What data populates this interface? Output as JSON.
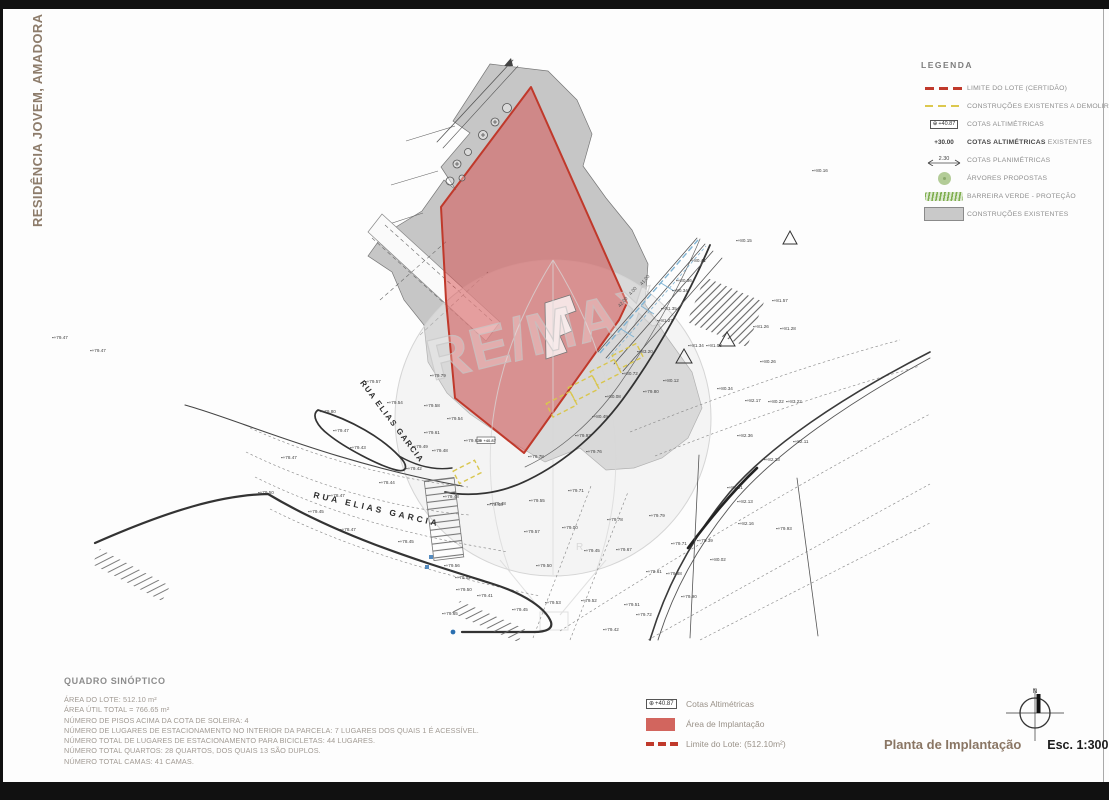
{
  "page": {
    "side_title": "RESIDÊNCIA JOVEM,  AMADORA",
    "drawing_title": "Planta de Implantação",
    "scale_label": "Esc. 1:300",
    "north_label": "N"
  },
  "colors": {
    "lot_red": "#c0392b",
    "implant_fill": "#d84a4a",
    "demolish_yellow": "#dcc84e",
    "existing_gray": "#c6c6c6",
    "tree_green": "#b3cc97",
    "barrier_green": "#7fae4f",
    "water_blue": "#7fb3d3"
  },
  "legend": {
    "title": "LEGENDA",
    "items": [
      {
        "label": "LIMITE DO LOTE (CERTIDÃO)"
      },
      {
        "label": "CONSTRUÇÕES EXISTENTES A DEMOLIR"
      },
      {
        "label": "COTAS ALTIMÉTRICAS",
        "symbol_value": "+40.87"
      },
      {
        "label_bold": "COTAS ALTIMÉTRICAS",
        "label_rest": " EXISTENTES",
        "symbol_value": "+30.00"
      },
      {
        "label": "COTAS PLANIMÉTRICAS",
        "symbol_value": "2.30"
      },
      {
        "label": "ÁRVORES PROPOSTAS"
      },
      {
        "label": "BARREIRA VERDE - PROTEÇÃO"
      },
      {
        "label": "CONSTRUÇÕES EXISTENTES"
      }
    ]
  },
  "map": {
    "watermark": "RE/MAX",
    "watermark_r": "R",
    "cota_box": "⊕ +40.87",
    "street_labels": [
      {
        "text": "RUA ELIAS GARCIA",
        "x": 390,
        "y": 423,
        "rot": 53,
        "fs": 8,
        "ls": 1.5
      },
      {
        "text": "RUA ELIAS GARCIA",
        "x": 376,
        "y": 512,
        "rot": 13,
        "fs": 8.5,
        "ls": 3
      }
    ],
    "dimension_labels": [
      {
        "text": "42.00",
        "x": 624,
        "y": 303,
        "rot": -49
      },
      {
        "text": "4.00",
        "x": 634,
        "y": 292,
        "rot": -49
      },
      {
        "text": "41.00",
        "x": 646,
        "y": 281,
        "rot": -49
      }
    ],
    "spot_elevations": [
      {
        "x": 365,
        "y": 383,
        "v": "+79.57"
      },
      {
        "x": 387,
        "y": 404,
        "v": "+79.54"
      },
      {
        "x": 424,
        "y": 407,
        "v": "+79.58"
      },
      {
        "x": 320,
        "y": 413,
        "v": "+79.80"
      },
      {
        "x": 447,
        "y": 420,
        "v": "+79.54"
      },
      {
        "x": 333,
        "y": 432,
        "v": "+79.47"
      },
      {
        "x": 424,
        "y": 434,
        "v": "+79.61"
      },
      {
        "x": 350,
        "y": 449,
        "v": "+79.43"
      },
      {
        "x": 412,
        "y": 448,
        "v": "+79.49"
      },
      {
        "x": 432,
        "y": 452,
        "v": "+79.48"
      },
      {
        "x": 281,
        "y": 459,
        "v": "+78.47"
      },
      {
        "x": 406,
        "y": 470,
        "v": "+79.42"
      },
      {
        "x": 379,
        "y": 484,
        "v": "+78.44"
      },
      {
        "x": 258,
        "y": 494,
        "v": "+79.50"
      },
      {
        "x": 329,
        "y": 497,
        "v": "+78.47"
      },
      {
        "x": 308,
        "y": 513,
        "v": "+79.45"
      },
      {
        "x": 443,
        "y": 498,
        "v": "+79.48"
      },
      {
        "x": 487,
        "y": 506,
        "v": "+79.48"
      },
      {
        "x": 340,
        "y": 531,
        "v": "+78.47"
      },
      {
        "x": 398,
        "y": 543,
        "v": "+78.45"
      },
      {
        "x": 464,
        "y": 442,
        "v": "+79.62"
      },
      {
        "x": 430,
        "y": 377,
        "v": "+79.79"
      },
      {
        "x": 528,
        "y": 458,
        "v": "+79.78"
      },
      {
        "x": 568,
        "y": 492,
        "v": "+79.71"
      },
      {
        "x": 529,
        "y": 502,
        "v": "+79.55"
      },
      {
        "x": 490,
        "y": 505,
        "v": "+79.48"
      },
      {
        "x": 607,
        "y": 521,
        "v": "+79.78"
      },
      {
        "x": 649,
        "y": 517,
        "v": "+79.79"
      },
      {
        "x": 524,
        "y": 533,
        "v": "+79.57"
      },
      {
        "x": 562,
        "y": 529,
        "v": "+79.00"
      },
      {
        "x": 584,
        "y": 552,
        "v": "+79.45"
      },
      {
        "x": 616,
        "y": 551,
        "v": "+79.67"
      },
      {
        "x": 671,
        "y": 545,
        "v": "+79.71"
      },
      {
        "x": 697,
        "y": 542,
        "v": "+79.39"
      },
      {
        "x": 710,
        "y": 561,
        "v": "+80.02"
      },
      {
        "x": 536,
        "y": 567,
        "v": "+79.50"
      },
      {
        "x": 455,
        "y": 579,
        "v": "+79.52"
      },
      {
        "x": 444,
        "y": 567,
        "v": "+79.56"
      },
      {
        "x": 456,
        "y": 591,
        "v": "+79.50"
      },
      {
        "x": 477,
        "y": 597,
        "v": "+79.41"
      },
      {
        "x": 442,
        "y": 615,
        "v": "+79.65"
      },
      {
        "x": 512,
        "y": 611,
        "v": "+79.45"
      },
      {
        "x": 545,
        "y": 604,
        "v": "+79.53"
      },
      {
        "x": 581,
        "y": 602,
        "v": "+79.52"
      },
      {
        "x": 624,
        "y": 606,
        "v": "+79.51"
      },
      {
        "x": 636,
        "y": 616,
        "v": "+79.72"
      },
      {
        "x": 666,
        "y": 575,
        "v": "+79.88"
      },
      {
        "x": 681,
        "y": 598,
        "v": "+79.90"
      },
      {
        "x": 646,
        "y": 573,
        "v": "+79.61"
      },
      {
        "x": 603,
        "y": 631,
        "v": "+79.42"
      },
      {
        "x": 690,
        "y": 262,
        "v": "+80.41"
      },
      {
        "x": 676,
        "y": 282,
        "v": "+80.36"
      },
      {
        "x": 672,
        "y": 292,
        "v": "+80.34"
      },
      {
        "x": 661,
        "y": 310,
        "v": "+81.35"
      },
      {
        "x": 657,
        "y": 322,
        "v": "+81.27"
      },
      {
        "x": 637,
        "y": 353,
        "v": "+83.20"
      },
      {
        "x": 622,
        "y": 375,
        "v": "+80.72"
      },
      {
        "x": 605,
        "y": 398,
        "v": "+80.08"
      },
      {
        "x": 592,
        "y": 418,
        "v": "+80.49"
      },
      {
        "x": 575,
        "y": 437,
        "v": "+79.92"
      },
      {
        "x": 586,
        "y": 453,
        "v": "+79.76"
      },
      {
        "x": 663,
        "y": 382,
        "v": "+80.12"
      },
      {
        "x": 643,
        "y": 393,
        "v": "+79.80"
      },
      {
        "x": 736,
        "y": 242,
        "v": "+80.15"
      },
      {
        "x": 772,
        "y": 302,
        "v": "+81.57"
      },
      {
        "x": 753,
        "y": 328,
        "v": "+81.26"
      },
      {
        "x": 780,
        "y": 330,
        "v": "+81.28"
      },
      {
        "x": 688,
        "y": 347,
        "v": "+81.34"
      },
      {
        "x": 706,
        "y": 347,
        "v": "+81.08"
      },
      {
        "x": 760,
        "y": 363,
        "v": "+80.26"
      },
      {
        "x": 717,
        "y": 390,
        "v": "+80.34"
      },
      {
        "x": 768,
        "y": 403,
        "v": "+80.22"
      },
      {
        "x": 745,
        "y": 402,
        "v": "+82.17"
      },
      {
        "x": 786,
        "y": 403,
        "v": "+83.22"
      },
      {
        "x": 737,
        "y": 437,
        "v": "+82.36"
      },
      {
        "x": 764,
        "y": 461,
        "v": "+82.23"
      },
      {
        "x": 793,
        "y": 443,
        "v": "+82.11"
      },
      {
        "x": 727,
        "y": 489,
        "v": "+81.91"
      },
      {
        "x": 737,
        "y": 503,
        "v": "+82.13"
      },
      {
        "x": 738,
        "y": 525,
        "v": "+82.16"
      },
      {
        "x": 776,
        "y": 530,
        "v": "+79.93"
      },
      {
        "x": 812,
        "y": 172,
        "v": "+80.16"
      },
      {
        "x": 52,
        "y": 339,
        "v": "+79.47"
      },
      {
        "x": 90,
        "y": 352,
        "v": "+79.47"
      }
    ]
  },
  "synoptic": {
    "title": "QUADRO SINÓPTICO",
    "lines": [
      "ÁREA DO LOTE: 512.10 m²",
      "ÁREA ÚTIL TOTAL = 766.65 m²",
      "NÚMERO DE PISOS ACIMA DA COTA DE SOLEIRA: 4",
      "NÚMERO DE LUGARES DE ESTACIONAMENTO NO INTERIOR DA PARCELA: 7 LUGARES DOS QUAIS 1 É ACESSÍVEL.",
      "NÚMERO TOTAL DE LUGARES DE ESTACIONAMENTO PARA BICICLETAS: 44 LUGARES.",
      "NÚMERO TOTAL QUARTOS: 28 QUARTOS, DOS QUAIS 13 SÃO DUPLOS.",
      "NÚMERO TOTAL CAMAS: 41 CAMAS."
    ]
  },
  "footer_legend": {
    "items": [
      {
        "label": "Cotas Altimétricas",
        "symbol_value": "+40.87"
      },
      {
        "label": "Área de Implantação"
      },
      {
        "label": "Limite do Lote: (512.10m²)"
      }
    ]
  }
}
